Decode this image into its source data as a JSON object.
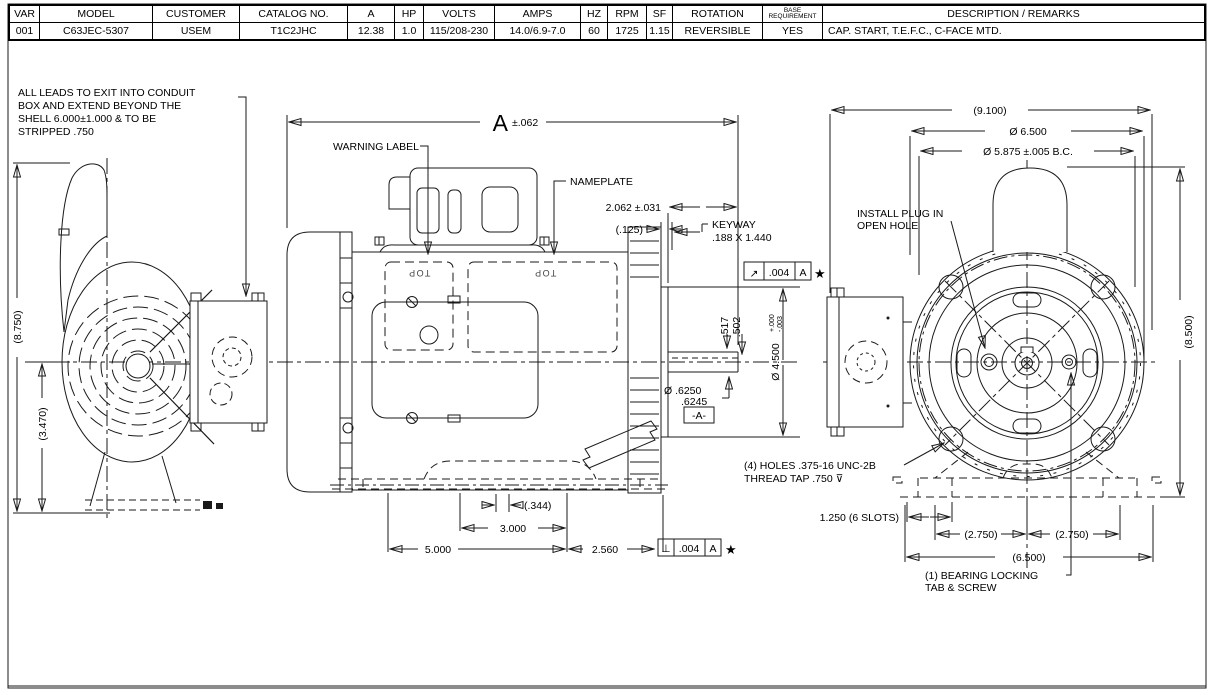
{
  "table": {
    "columns": [
      {
        "header": "VAR",
        "value": "001"
      },
      {
        "header": "MODEL",
        "value": "C63JEC-5307"
      },
      {
        "header": "CUSTOMER",
        "value": "USEM"
      },
      {
        "header": "CATALOG NO.",
        "value": "T1C2JHC"
      },
      {
        "header": "A",
        "value": "12.38"
      },
      {
        "header": "HP",
        "value": "1.0"
      },
      {
        "header": "VOLTS",
        "value": "115/208-230"
      },
      {
        "header": "AMPS",
        "value": "14.0/6.9-7.0"
      },
      {
        "header": "HZ",
        "value": "60"
      },
      {
        "header": "RPM",
        "value": "1725"
      },
      {
        "header": "SF",
        "value": "1.15"
      },
      {
        "header": "ROTATION",
        "value": "REVERSIBLE"
      },
      {
        "header": "BASE REQUIREMENT",
        "value": "YES"
      },
      {
        "header": "DESCRIPTION / REMARKS",
        "value": "CAP. START, T.E.F.C., C-FACE MTD."
      }
    ]
  },
  "notes": {
    "leads_1": "ALL LEADS TO EXIT INTO CONDUIT",
    "leads_2": "BOX AND EXTEND BEYOND THE",
    "leads_3": "SHELL 6.000±1.000 & TO BE",
    "leads_4": "STRIPPED .750",
    "warning_label": "WARNING LABEL",
    "nameplate": "NAMEPLATE",
    "install_plug_1": "INSTALL PLUG IN",
    "install_plug_2": "OPEN HOLE",
    "holes_1": "(4) HOLES .375-16 UNC-2B",
    "holes_2": "THREAD TAP .750 ⊽",
    "bearing_1": "(1) BEARING LOCKING",
    "bearing_2": "TAB & SCREW",
    "top_label": "TOP"
  },
  "dims": {
    "overall_a": "A",
    "overall_a_tol": "±.062",
    "shaft_ext": "2.062 ±.031",
    "gap": "(.125)",
    "keyway_1": "KEYWAY",
    "keyway_2": ".188 X 1.440",
    "height_overall": "(8.750)",
    "height_center": "(3.470)",
    "width_overall": "(9.100)",
    "dia_6500": "Ø 6.500",
    "bolt_circle": "Ø 5.875 ±.005 B.C.",
    "height_right": "(8.500)",
    "key_depth_1": ".517",
    "key_depth_2": ".502",
    "dia_4500": "Ø 4.500",
    "dia_4500_tol_1": "+.000",
    "dia_4500_tol_2": "-.003",
    "shaft_dia_1": "Ø .6250",
    "shaft_dia_2": ".6245",
    "datum": "-A-",
    "slots": "1.250 (6 SLOTS)",
    "foot_l": "(2.750)",
    "foot_r": "(2.750)",
    "foot_span": "(6.500)",
    "slot_w": "(.344)",
    "foot_3": "3.000",
    "foot_5": "5.000",
    "face_foot": "2.560",
    "fcf_runout_sym": "↗",
    "fcf_runout_val": ".004",
    "fcf_runout_datum": "A",
    "fcf_perp_sym": "⊥",
    "fcf_perp_val": ".004",
    "fcf_perp_datum": "A",
    "fcf_star": "★"
  }
}
